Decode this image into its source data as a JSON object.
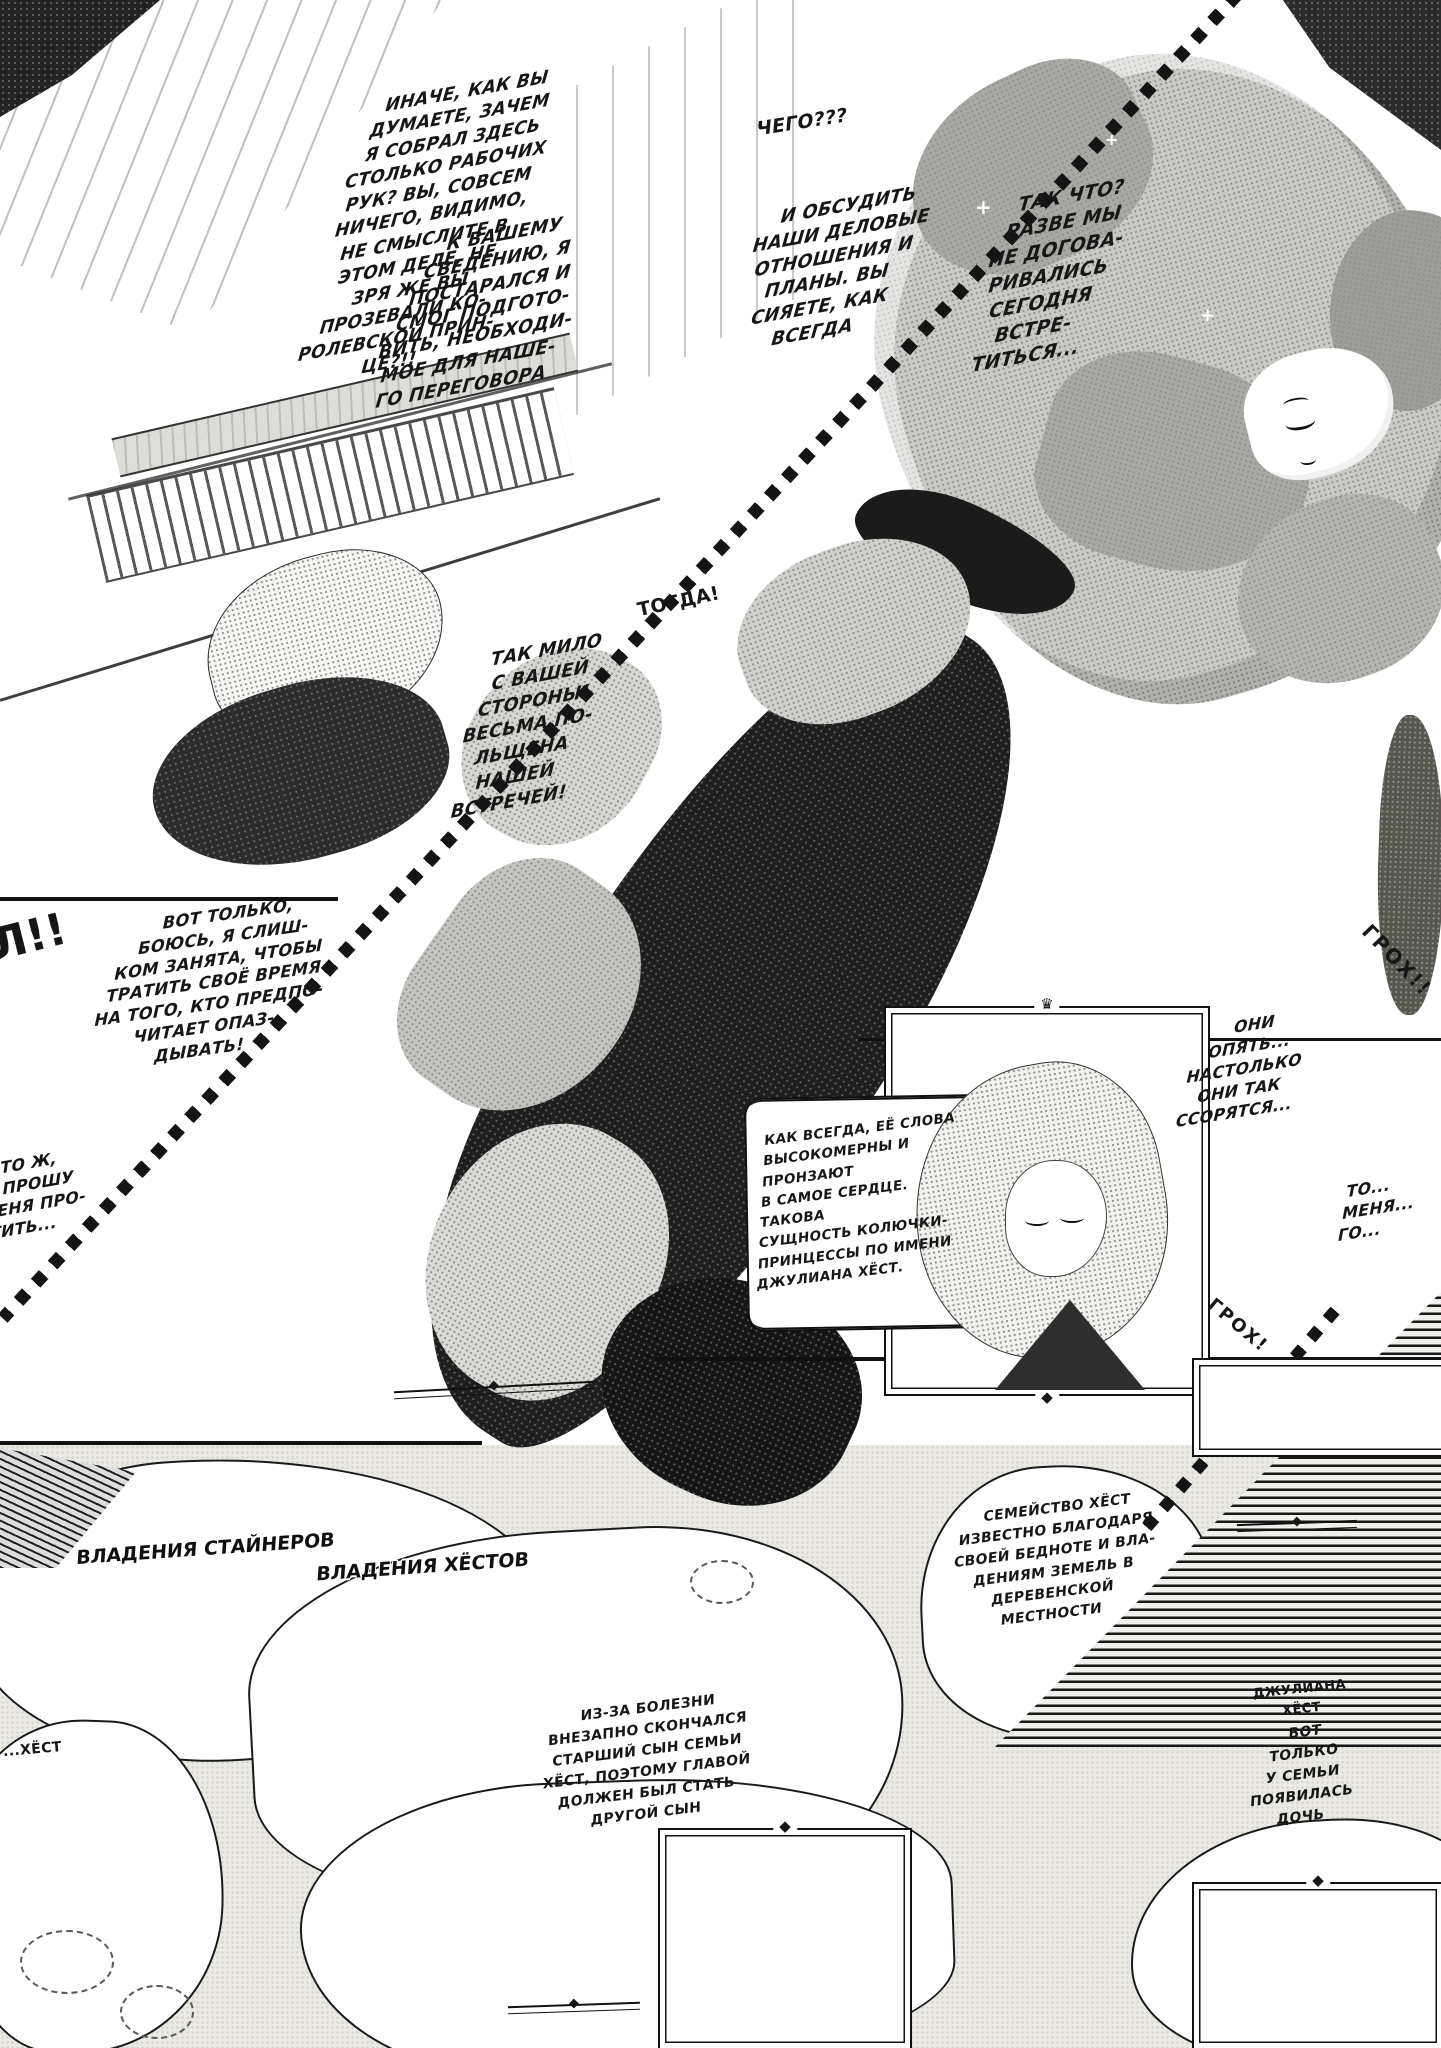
{
  "page": {
    "kind": "manga-page",
    "language": "ru",
    "bg": "#ffffff",
    "ink": "#161616"
  },
  "bubbles": [
    {
      "name": "foreman-speech",
      "text": "ИНАЧЕ, КАК ВЫ\nДУМАЕТЕ, ЗАЧЕМ\nЯ СОБРАЛ ЗДЕСЬ\nСТОЛЬКО РАБОЧИХ\nРУК? ВЫ, СОВСЕМ\nНИЧЕГО, ВИДИМО,\nНЕ СМЫСЛИТЕ В\nЭТОМ ДЕЛЕ, НЕ\nЗРЯ ЖЕ ВЫ\nПРОЗЕВАЛИ КО-\nРОЛЕВСКОЙ ПРИН-\nЦЕ?!!"
    },
    {
      "name": "preparation-speech",
      "text": "К ВАШЕМУ\nСВЕДЕНИЮ, Я\nПОСТАРАЛСЯ И\nСМОГ ПОДГОТО-\nВИТЬ, НЕОБХОДИ-\nМОЕ ДЛЯ НАШЕ-\nГО ПЕРЕГОВОРА"
    },
    {
      "name": "chego-exclaim",
      "text": "ЧЕГО???"
    },
    {
      "name": "tak-chto-speech",
      "text": "ТАК ЧТО?\nРАЗВЕ МЫ\nНЕ ДОГОВА-\nРИВАЛИСЬ\nСЕГОДНЯ\nВСТРЕ-\nТИТЬСЯ..."
    },
    {
      "name": "obsudit-speech",
      "text": "И ОБСУДИТЬ\nНАШИ ДЕЛОВЫЕ\nОТНОШЕНИЯ И\nПЛАНЫ. ВЫ\nСИЯЕТЕ, КАК\nВСЕГДА"
    },
    {
      "name": "togda-exclaim",
      "text": "ТОГДА!"
    },
    {
      "name": "tak-milo-speech",
      "text": "ТАК МИЛО\nС ВАШЕЙ\nСТОРОНЫ!\nВЕСЬМА ПО-\nЛЬЩЕНА\nНАШЕЙ\nВСТРЕЧЕЙ!"
    },
    {
      "name": "vot-tolko-speech",
      "text": "ВОТ ТОЛЬКО,\nБОЮСЬ, Я СЛИШ-\nКОМ ЗАНЯТА, ЧТОБЫ\nТРАТИТЬ СВОЁ ВРЕМЯ\nНА ТОГО, КТО ПРЕДПО-\nЧИТАЕТ ОПАЗ-\nДЫВАТЬ!"
    },
    {
      "name": "chto-zh-speech",
      "text": "ЧТО Ж,\nЯ ПРОШУ\nМЕНЯ ПРО-\nСТИТЬ..."
    },
    {
      "name": "oni-opyat-thought",
      "text": "ОНИ\nОПЯТЬ...\nНАСТОЛЬКО\nОНИ ТАК\nССОРЯТСЯ..."
    },
    {
      "name": "edge-fragment",
      "text": "ТО...\nМЕНЯ...\nГО..."
    }
  ],
  "captions": [
    {
      "name": "narration-juliana",
      "text": "КАК ВСЕГДА, ЕЁ СЛОВА\nВЫСОКОМЕРНЫ И ПРОНЗАЮТ\nВ САМОЕ СЕРДЦЕ. ТАКОВА\nСУЩНОСТЬ КОЛЮЧКИ-\nПРИНЦЕССЫ ПО ИМЕНИ\nДЖУЛИАНА ХЁСТ."
    },
    {
      "name": "hoest-family",
      "text": "СЕМЕЙСТВО ХЁСТ\nИЗВЕСТНО БЛАГОДАРЯ\nСВОЕЙ БЕДНОТЕ И ВЛА-\nДЕНИЯМ ЗЕМЕЛЬ В\nДЕРЕВЕНСКОЙ\nМЕСТНОСТИ"
    },
    {
      "name": "illness-story",
      "text": "ИЗ-ЗА БОЛЕЗНИ\nВНЕЗАПНО СКОНЧАЛСЯ\nСТАРШИЙ СЫН СЕМЬИ\nХЁСТ, ПОЭТОМУ ГЛАВОЙ\nДОЛЖЕН БЫЛ СТАТЬ\nДРУГОЙ СЫН"
    },
    {
      "name": "daughter-note",
      "text": "ВОТ\nТОЛЬКО\nУ СЕМЬИ\nПОЯВИЛАСЬ\nДОЧЬ"
    },
    {
      "name": "juliana-name",
      "text": "ДЖУЛИАНА\nХЁСТ"
    },
    {
      "name": "left-edge-fragment",
      "text": "...ХЁСТ"
    }
  ],
  "labels": [
    {
      "name": "steiner-lands",
      "text": "ВЛАДЕНИЯ СТАЙНЕРОВ"
    },
    {
      "name": "hoest-lands",
      "text": "ВЛАДЕНИЯ ХЁСТОВ"
    }
  ],
  "sfx": [
    {
      "name": "sfx-groh-top",
      "text": "ГРОХ!!"
    },
    {
      "name": "sfx-groh-bottom",
      "text": "ГРОХ!"
    },
    {
      "name": "sfx-left-edge",
      "text": "Л!!"
    }
  ],
  "ornaments": {
    "crown": "♛",
    "diamond": "◆",
    "sparkle": "+"
  }
}
